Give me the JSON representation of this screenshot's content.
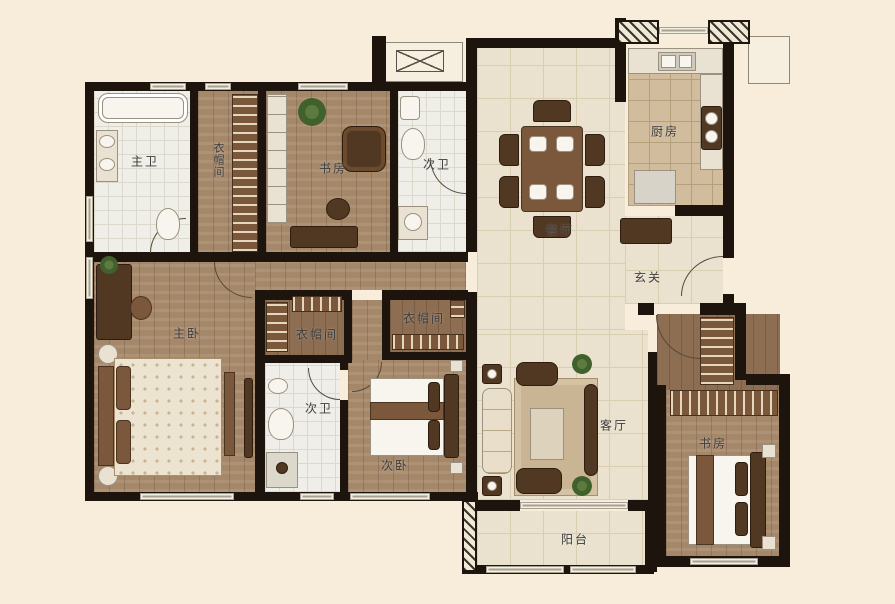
{
  "colors": {
    "background": "#f8edda",
    "wall": "#1d150d",
    "wood_floor": "#a5876a",
    "tile_floor": "#eae2cf",
    "kitchen_floor": "#d1bd9d",
    "label_text": "#3c3c3c"
  },
  "rooms": [
    {
      "id": "master-bath",
      "label": "主卫"
    },
    {
      "id": "closet-corridor",
      "label": "衣帽间"
    },
    {
      "id": "study-top",
      "label": "书房"
    },
    {
      "id": "bath-top",
      "label": "次卫"
    },
    {
      "id": "dining",
      "label": "餐厅"
    },
    {
      "id": "kitchen",
      "label": "厨房"
    },
    {
      "id": "foyer",
      "label": "玄关"
    },
    {
      "id": "master-bedroom",
      "label": "主卧"
    },
    {
      "id": "closet-left",
      "label": "衣帽间"
    },
    {
      "id": "closet-right",
      "label": "衣帽间"
    },
    {
      "id": "bath-bottom",
      "label": "次卫"
    },
    {
      "id": "second-bedroom",
      "label": "次卧"
    },
    {
      "id": "living",
      "label": "客厅"
    },
    {
      "id": "study-bottom",
      "label": "书房"
    },
    {
      "id": "balcony",
      "label": "阳台"
    }
  ]
}
